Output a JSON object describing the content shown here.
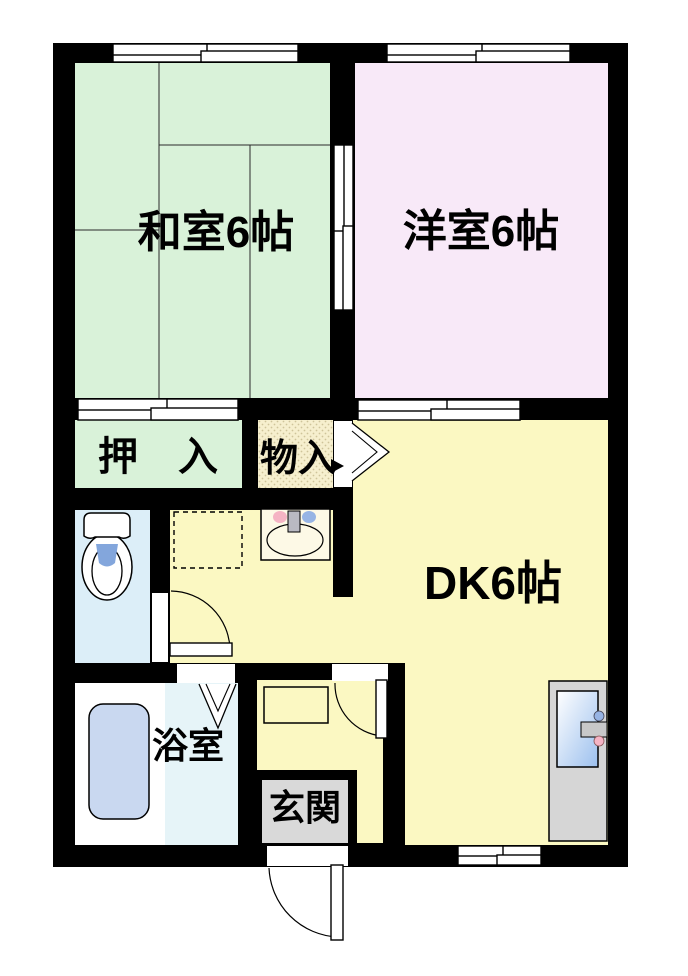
{
  "floorplan": {
    "background": "#ffffff",
    "wall_color": "#000000",
    "rooms": {
      "washitsu": {
        "label": "和室6帖",
        "color": "#d9f2d9"
      },
      "youshitsu": {
        "label": "洋室6帖",
        "color": "#f8e9f8"
      },
      "dk": {
        "label": "DK6帖",
        "color": "#fbf8c2"
      },
      "oshiire": {
        "label": "押　入",
        "color": "#d9f2d9"
      },
      "monoire": {
        "label": "物入",
        "color": "#f6efce",
        "dot_color": "#cfc49a"
      },
      "toilet": {
        "color": "#dceef8"
      },
      "yokushitsu": {
        "label": "浴室",
        "color": "#e6f4f8",
        "floor_color": "#ffffff",
        "tub_color": "#c9d8f0"
      },
      "genkan": {
        "label": "玄関",
        "color": "#d9d9d9"
      }
    },
    "fixtures": {
      "toilet_water_color": "#83a6dc",
      "faucet_hot_color": "#f5b4c4",
      "faucet_cold_color": "#97b4e4",
      "spout_color": "#b9b9c2",
      "appliance_body_color": "#d6d6d6",
      "appliance_handle_color": "#c8c8c8",
      "appliance_glass_color": "#9cc0ee",
      "sink_counter_color": "#fdf9e6"
    }
  }
}
